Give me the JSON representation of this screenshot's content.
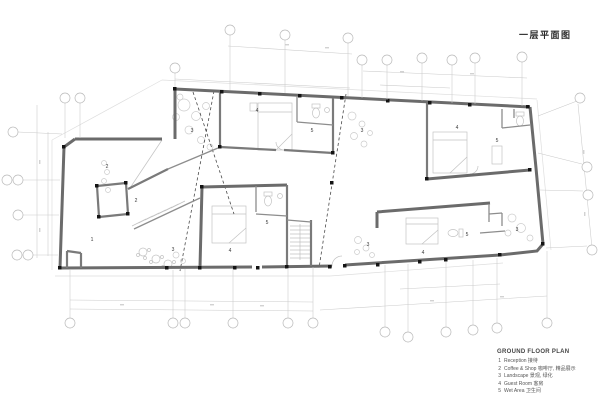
{
  "document": {
    "title": "一层平面图",
    "legend": {
      "title": "GROUND FLOOR PLAN",
      "items": [
        {
          "num": "1",
          "label": "Reception 接待"
        },
        {
          "num": "2",
          "label": "Coffee & Shop 咖啡厅, 精品展示"
        },
        {
          "num": "3",
          "label": "Landscape 景观, 绿化"
        },
        {
          "num": "4",
          "label": "Guest Room 客房"
        },
        {
          "num": "5",
          "label": "Wet Area 卫生间"
        }
      ]
    }
  },
  "plan": {
    "colors": {
      "wall": "#6b6b6b",
      "column": "#141414",
      "dimension_lines": "#c9c9c9",
      "dashed_section_line": "#4a4a4a",
      "furniture": "#c2c2c2"
    },
    "room_labels": [
      {
        "label": "1",
        "x": 92,
        "y": 239
      },
      {
        "label": "2",
        "x": 107,
        "y": 166
      },
      {
        "label": "2",
        "x": 136,
        "y": 200
      },
      {
        "label": "3",
        "x": 192,
        "y": 130
      },
      {
        "label": "3",
        "x": 362,
        "y": 130
      },
      {
        "label": "3",
        "x": 173,
        "y": 249
      },
      {
        "label": "3",
        "x": 368,
        "y": 244
      },
      {
        "label": "3",
        "x": 517,
        "y": 229
      },
      {
        "label": "4",
        "x": 257,
        "y": 110
      },
      {
        "label": "4",
        "x": 457,
        "y": 127
      },
      {
        "label": "4",
        "x": 230,
        "y": 250
      },
      {
        "label": "4",
        "x": 423,
        "y": 252
      },
      {
        "label": "5",
        "x": 312,
        "y": 130
      },
      {
        "label": "5",
        "x": 497,
        "y": 140
      },
      {
        "label": "5",
        "x": 267,
        "y": 222
      },
      {
        "label": "5",
        "x": 467,
        "y": 234
      }
    ],
    "grid_bubbles": [
      [
        230,
        30
      ],
      [
        285,
        35
      ],
      [
        348,
        38
      ],
      [
        175,
        68
      ],
      [
        362,
        60
      ],
      [
        387,
        60
      ],
      [
        422,
        58
      ],
      [
        452,
        60
      ],
      [
        475,
        58
      ],
      [
        522,
        57
      ],
      [
        580,
        98
      ],
      [
        65,
        98
      ],
      [
        80,
        98
      ],
      [
        13,
        132
      ],
      [
        7,
        180
      ],
      [
        18,
        180
      ],
      [
        18,
        215
      ],
      [
        17,
        255
      ],
      [
        28,
        255
      ],
      [
        70,
        323
      ],
      [
        173,
        323
      ],
      [
        185,
        323
      ],
      [
        233,
        323
      ],
      [
        288,
        323
      ],
      [
        313,
        323
      ],
      [
        385,
        332
      ],
      [
        408,
        337
      ],
      [
        446,
        332
      ],
      [
        473,
        330
      ],
      [
        497,
        328
      ],
      [
        547,
        323
      ],
      [
        587,
        167
      ],
      [
        588,
        195
      ],
      [
        592,
        250
      ]
    ],
    "bubble_stems": [
      [
        230,
        35,
        230,
        90
      ],
      [
        285,
        40,
        285,
        93
      ],
      [
        348,
        43,
        348,
        96
      ],
      [
        175,
        73,
        175,
        87
      ],
      [
        362,
        65,
        362,
        98
      ],
      [
        387,
        65,
        387,
        100
      ],
      [
        422,
        63,
        422,
        101
      ],
      [
        452,
        65,
        452,
        103
      ],
      [
        475,
        63,
        475,
        104
      ],
      [
        522,
        62,
        522,
        106
      ],
      [
        577,
        101,
        538,
        116
      ],
      [
        65,
        103,
        65,
        138
      ],
      [
        80,
        103,
        80,
        138
      ],
      [
        18,
        132,
        62,
        134
      ],
      [
        23,
        180,
        60,
        180
      ],
      [
        23,
        215,
        59,
        215
      ],
      [
        33,
        255,
        58,
        255
      ],
      [
        70,
        318,
        70,
        270
      ],
      [
        173,
        318,
        173,
        270
      ],
      [
        185,
        318,
        185,
        269
      ],
      [
        233,
        318,
        233,
        269
      ],
      [
        288,
        318,
        288,
        268
      ],
      [
        313,
        318,
        313,
        267
      ],
      [
        385,
        327,
        385,
        265
      ],
      [
        408,
        332,
        408,
        264
      ],
      [
        446,
        327,
        446,
        262
      ],
      [
        473,
        325,
        473,
        260
      ],
      [
        497,
        323,
        497,
        258
      ],
      [
        547,
        318,
        547,
        251
      ],
      [
        582,
        164,
        538,
        153
      ],
      [
        583,
        191,
        540,
        190
      ],
      [
        587,
        246,
        546,
        248
      ]
    ]
  }
}
